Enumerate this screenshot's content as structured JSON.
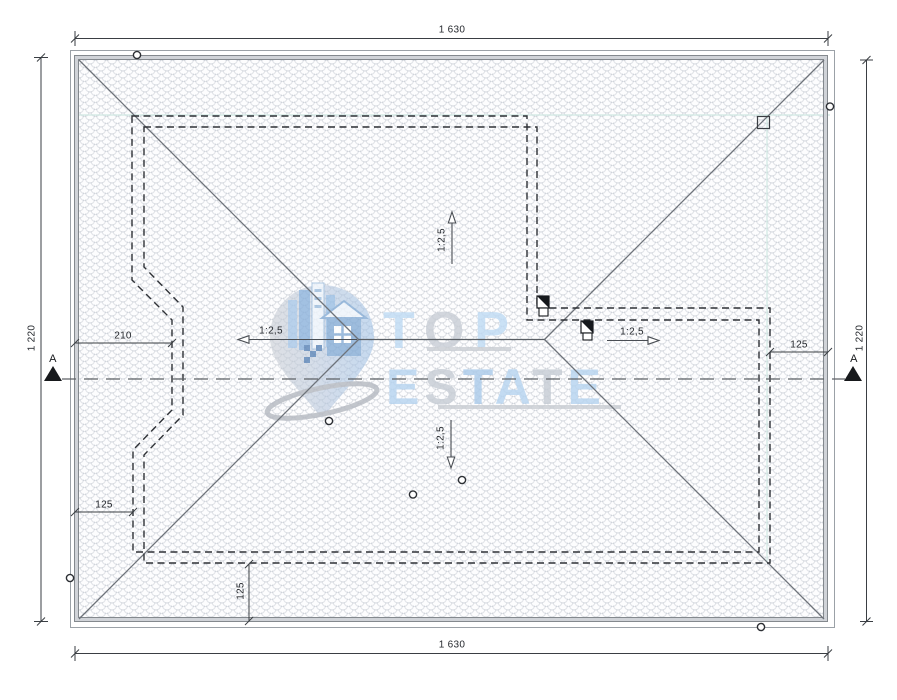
{
  "title": "Roof plan drawing",
  "dimensions": {
    "overall_width_top": "1 630",
    "overall_width_bottom": "1 630",
    "overall_height_left": "1 220",
    "overall_height_right": "1 220",
    "notch_offset": "210",
    "eave_overhang_left": "125",
    "eave_overhang_right": "125",
    "eave_overhang_bottom": "125"
  },
  "slopes": {
    "left": "1:2,5",
    "right": "1:2,5",
    "up": "1:2,5",
    "down": "1:2,5"
  },
  "section_marker": {
    "left": "A",
    "right": "A"
  },
  "watermark": {
    "top_letters": [
      "T",
      "O",
      "P"
    ],
    "estate_letters": [
      "E",
      "S",
      "T",
      "A",
      "T",
      "E"
    ]
  },
  "colors": {
    "eave_band": "#d0d3d8",
    "drawing_line": "#3a3e43",
    "roof_line": "#6e737a",
    "dashed_wall": "#2e3136",
    "teal_guide": "#cfe7e2",
    "watermark_blue": "#b7d4f0",
    "watermark_gray": "#c7cdd5"
  }
}
